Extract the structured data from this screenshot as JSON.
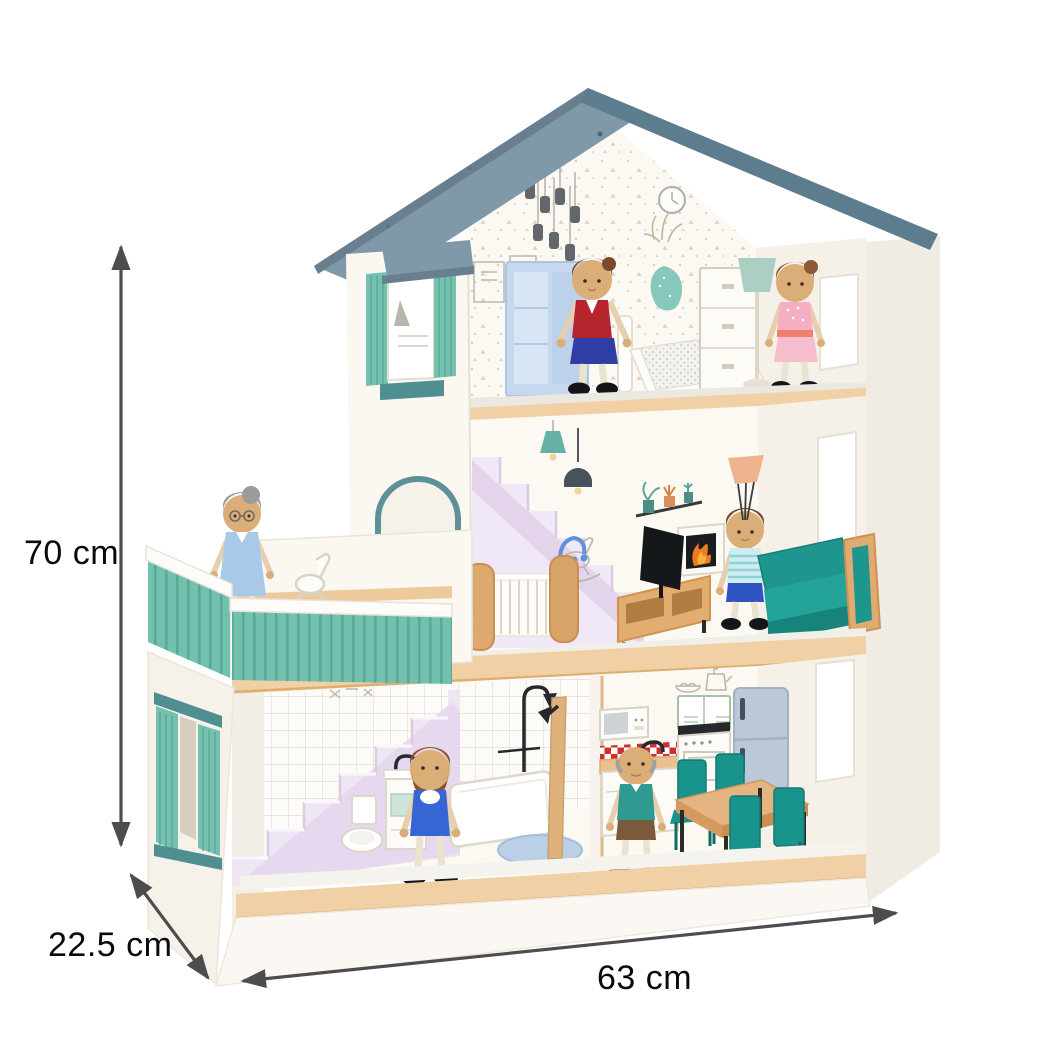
{
  "image": {
    "description": "Wooden three-storey toy dollhouse with furniture and six peg dolls, annotated with product dimensions",
    "background_color": "#ffffff"
  },
  "dimensions": {
    "height_label": "70 cm",
    "depth_label": "22.5 cm",
    "width_label": "63 cm"
  },
  "palette": {
    "roof": "#7f99a9",
    "roof_edge": "#5d7d8f",
    "walls": "#f7f3ec",
    "wood_trim": "#f1d0a5",
    "shutter_teal": "#74c1b0",
    "railing_teal": "#72c0ae",
    "dark_teal_sill": "#4f8e91",
    "sofa_teal": "#1d968e",
    "stairs_lilac": "#efe6f4",
    "wardrobe_blue": "#c5d8ee",
    "fridge_blue": "#bac8d7",
    "fire_orange": "#ee7a22",
    "annotation_line": "#4d4d4d",
    "annotation_text": "#000000"
  },
  "scene": {
    "attic_bedroom": [
      "pendant-lights",
      "wall-clock",
      "picture-frames",
      "wardrobe",
      "mother-doll",
      "bed",
      "vase-with-grass",
      "dresser",
      "floor-lamp",
      "girl-doll",
      "window"
    ],
    "middle_floor": [
      "balcony",
      "grandmother-doll",
      "rocking-horse",
      "teal-railing",
      "arched-door",
      "staircase",
      "pendant-lamps",
      "baby-crib",
      "wall-art",
      "tv-stand",
      "tv",
      "fireplace",
      "plant-shelf",
      "boy-doll",
      "sofa",
      "wall-lamp",
      "window"
    ],
    "ground_floor": [
      "staircase",
      "tiled-wall",
      "toilet",
      "sink-vanity",
      "bathtub",
      "shower",
      "father-doll",
      "partition-wall",
      "microwave",
      "checker-backsplash",
      "kitchen-counter",
      "oven",
      "fridge",
      "grandfather-doll",
      "dining-table",
      "four-chairs",
      "window"
    ],
    "exterior": [
      "grey-gabled-roof",
      "tower-window-with-shutters",
      "left-wall-window-with-shutters",
      "wooden-floor-beams",
      "white-base"
    ]
  }
}
